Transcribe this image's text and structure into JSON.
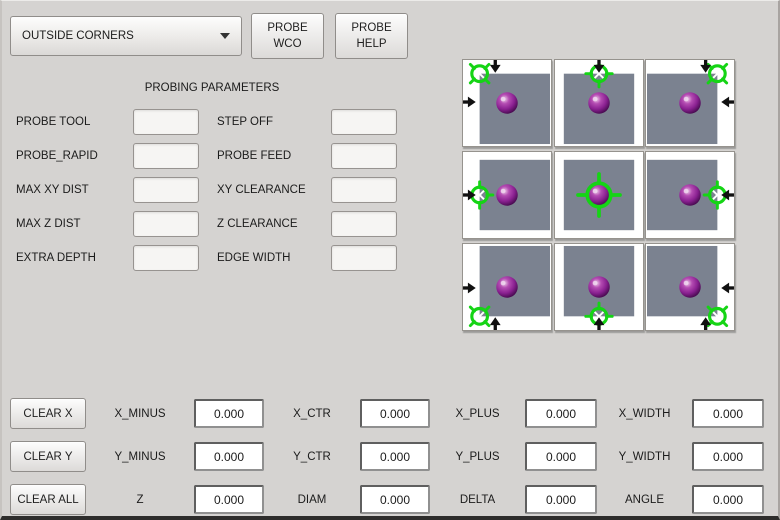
{
  "toolbar": {
    "mode_dropdown": {
      "value": "OUTSIDE CORNERS"
    },
    "buttons": [
      {
        "label": "PROBE WCO"
      },
      {
        "label": "PROBE HELP"
      }
    ]
  },
  "parameters": {
    "title": "PROBING PARAMETERS",
    "left": [
      {
        "label": "PROBE TOOL",
        "value": ""
      },
      {
        "label": "PROBE_RAPID",
        "value": ""
      },
      {
        "label": "MAX XY DIST",
        "value": ""
      },
      {
        "label": "MAX Z DIST",
        "value": ""
      },
      {
        "label": "EXTRA DEPTH",
        "value": ""
      }
    ],
    "right": [
      {
        "label": "STEP OFF",
        "value": ""
      },
      {
        "label": "PROBE FEED",
        "value": ""
      },
      {
        "label": "XY CLEARANCE",
        "value": ""
      },
      {
        "label": "Z CLEARANCE",
        "value": ""
      },
      {
        "label": "EDGE WIDTH",
        "value": ""
      }
    ]
  },
  "probe_grid": {
    "colors": {
      "square": "#7b8290",
      "crosshair": "#15d415",
      "arrow": "#111111",
      "sphere": "#93278f"
    },
    "cells": [
      {
        "position": "top-left",
        "arrows": [
          "down",
          "right"
        ]
      },
      {
        "position": "top-center",
        "arrows": [
          "down"
        ]
      },
      {
        "position": "top-right",
        "arrows": [
          "down",
          "left"
        ]
      },
      {
        "position": "middle-left",
        "arrows": [
          "right"
        ]
      },
      {
        "position": "center",
        "arrows": []
      },
      {
        "position": "middle-right",
        "arrows": [
          "left"
        ]
      },
      {
        "position": "bottom-left",
        "arrows": [
          "right",
          "up"
        ]
      },
      {
        "position": "bottom-center",
        "arrows": [
          "up"
        ]
      },
      {
        "position": "bottom-right",
        "arrows": [
          "left",
          "up"
        ]
      }
    ]
  },
  "results": {
    "rows": [
      {
        "button": "CLEAR X",
        "cells": [
          {
            "label": "X_MINUS",
            "value": "0.000"
          },
          {
            "label": "X_CTR",
            "value": "0.000"
          },
          {
            "label": "X_PLUS",
            "value": "0.000"
          },
          {
            "label": "X_WIDTH",
            "value": "0.000"
          }
        ]
      },
      {
        "button": "CLEAR Y",
        "cells": [
          {
            "label": "Y_MINUS",
            "value": "0.000"
          },
          {
            "label": "Y_CTR",
            "value": "0.000"
          },
          {
            "label": "Y_PLUS",
            "value": "0.000"
          },
          {
            "label": "Y_WIDTH",
            "value": "0.000"
          }
        ]
      },
      {
        "button": "CLEAR ALL",
        "cells": [
          {
            "label": "Z",
            "value": "0.000"
          },
          {
            "label": "DIAM",
            "value": "0.000"
          },
          {
            "label": "DELTA",
            "value": "0.000"
          },
          {
            "label": "ANGLE",
            "value": "0.000"
          }
        ]
      }
    ]
  }
}
